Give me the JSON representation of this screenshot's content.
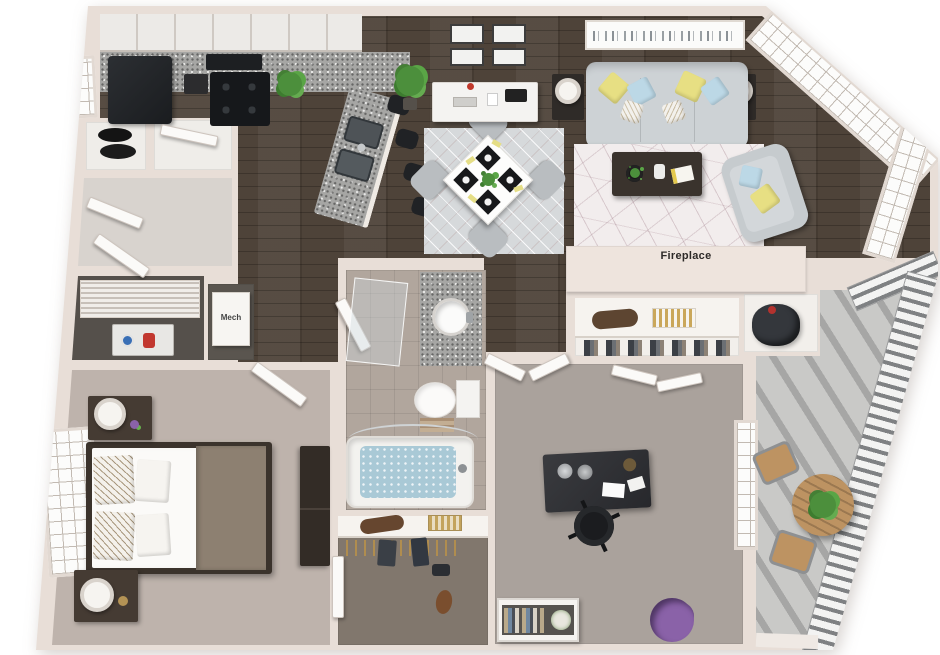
{
  "scene": {
    "type": "apartment-floor-plan-3d-top-view",
    "visible_text": [
      "Fireplace",
      "Mech"
    ]
  },
  "labels": {
    "fireplace": "Fireplace",
    "mech": "Mech"
  },
  "palette": {
    "wall": "#e8ded7",
    "wood_floor": "#4e4339",
    "bedroom_floor": "#beb3ac",
    "office_floor": "#aaa29c",
    "walkin_closet_floor": "#81776d",
    "bathroom_tile": "#b1a69d",
    "balcony_concrete": "#c9c9c7",
    "granite_counter": "#a6a6a4",
    "appliance_black": "#1d1f22",
    "sofa_gray": "#cdd2d5",
    "accent_yellow": "#e7df83",
    "accent_blue": "#bcd8e6",
    "bed_throw_taupe": "#8d8071",
    "outdoor_wood": "#bd9362",
    "plant_green": "#4c8f3c",
    "flower_purple": "#8a62a8",
    "tub_water": "#a9c9d6"
  },
  "rooms": [
    {
      "id": "kitchen",
      "furniture": [
        "upper-cabinets",
        "granite-counter",
        "refrigerator",
        "range-with-burners",
        "microwave",
        "coffee-machine",
        "counter-plant",
        "sink-peninsula",
        "bar-stools",
        "left-window"
      ]
    },
    {
      "id": "entry-closets",
      "furniture": [
        "storage-closet-discs",
        "closet-door",
        "vestibule-doors"
      ]
    },
    {
      "id": "laundry-closet",
      "furniture": [
        "louvered-doors",
        "washer-dryer"
      ]
    },
    {
      "id": "mech-closet",
      "label": "Mech",
      "furniture": [
        "mechanical-unit"
      ]
    },
    {
      "id": "dining-area",
      "furniture": [
        "diamond-rug",
        "square-table",
        "four-chairs",
        "four-place-settings",
        "wall-art-grid",
        "sideboard",
        "floor-plant"
      ]
    },
    {
      "id": "living-room",
      "label": "Fireplace",
      "furniture": [
        "skyline-art",
        "sofa",
        "throw-pillows",
        "side-tables-with-lamps",
        "geometric-rug",
        "coffee-table",
        "armchair",
        "bay-windows",
        "fireplace"
      ]
    },
    {
      "id": "bathroom",
      "furniture": [
        "shower-glass",
        "granite-vanity",
        "round-sink",
        "toilet",
        "bathtub-with-water",
        "towels",
        "curtain-rod"
      ]
    },
    {
      "id": "master-bedroom",
      "furniture": [
        "left-window",
        "bed",
        "patterned-pillows",
        "taupe-throw",
        "two-nightstands",
        "two-lamps",
        "dresser",
        "entry-door"
      ]
    },
    {
      "id": "walk-in-closet",
      "furniture": [
        "shelf",
        "duffel-bag",
        "basket",
        "hanging-rod",
        "clothes",
        "shoes",
        "side-door"
      ]
    },
    {
      "id": "office-bedroom",
      "furniture": [
        "french-doors",
        "wall-closet-with-shelf",
        "bifold-doors",
        "desk",
        "office-chair",
        "bookshelf",
        "purple-plant",
        "right-window"
      ]
    },
    {
      "id": "balcony",
      "furniture": [
        "grill-niche",
        "railing",
        "round-bistro-table",
        "two-chairs",
        "potted-plants"
      ]
    }
  ]
}
